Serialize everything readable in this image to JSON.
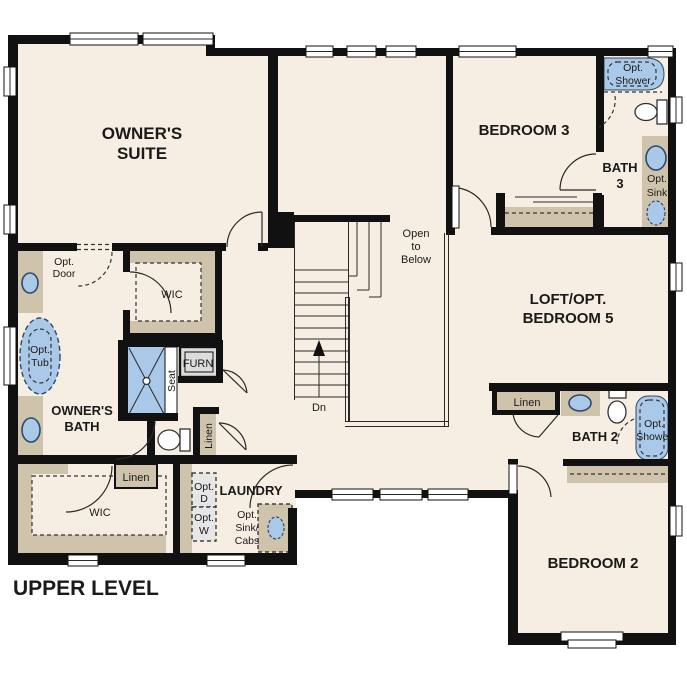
{
  "floor_plan": {
    "title": "UPPER LEVEL",
    "colors": {
      "floor": "#f6eee2",
      "wall": "#111111",
      "casework_tan": "#cfc3ab",
      "fixture_blue": "#aac9e8",
      "fixture_blue_stroke": "#2c4a6e",
      "furnace_gray": "#dcdcdc",
      "appliance_gray": "#e6e6e6"
    },
    "areas": {
      "owners_suite": {
        "name_1": "OWNER'S",
        "name_2": "SUITE"
      },
      "owners_bath": {
        "name_1": "OWNER'S",
        "name_2": "BATH",
        "opt_tub_1": "Opt.",
        "opt_tub_2": "Tub",
        "opt_door_1": "Opt.",
        "opt_door_2": "Door",
        "seat": "Seat",
        "furn": "FURN",
        "linen": "Linen",
        "wic": "WIC"
      },
      "wic_lower": {
        "name": "WIC",
        "linen": "Linen"
      },
      "laundry": {
        "name": "LAUNDRY",
        "opt_d_1": "Opt.",
        "opt_d_2": "D",
        "opt_w_1": "Opt.",
        "opt_w_2": "W",
        "opt_sink_cabs_1": "Opt.",
        "opt_sink_cabs_2": "Sink/",
        "opt_sink_cabs_3": "Cabs"
      },
      "stairs": {
        "dn": "Dn",
        "open_1": "Open",
        "open_2": "to",
        "open_3": "Below"
      },
      "bedroom3": {
        "name": "BEDROOM 3"
      },
      "bath3": {
        "name_1": "BATH",
        "name_2": "3",
        "opt_shower_1": "Opt.",
        "opt_shower_2": "Shower",
        "opt_sink_1": "Opt.",
        "opt_sink_2": "Sink"
      },
      "loft": {
        "name_1": "LOFT/OPT.",
        "name_2": "BEDROOM 5"
      },
      "bath2": {
        "name": "BATH 2",
        "linen": "Linen",
        "opt_shower_1": "Opt.",
        "opt_shower_2": "Shower"
      },
      "bedroom2": {
        "name": "BEDROOM 2"
      }
    }
  }
}
